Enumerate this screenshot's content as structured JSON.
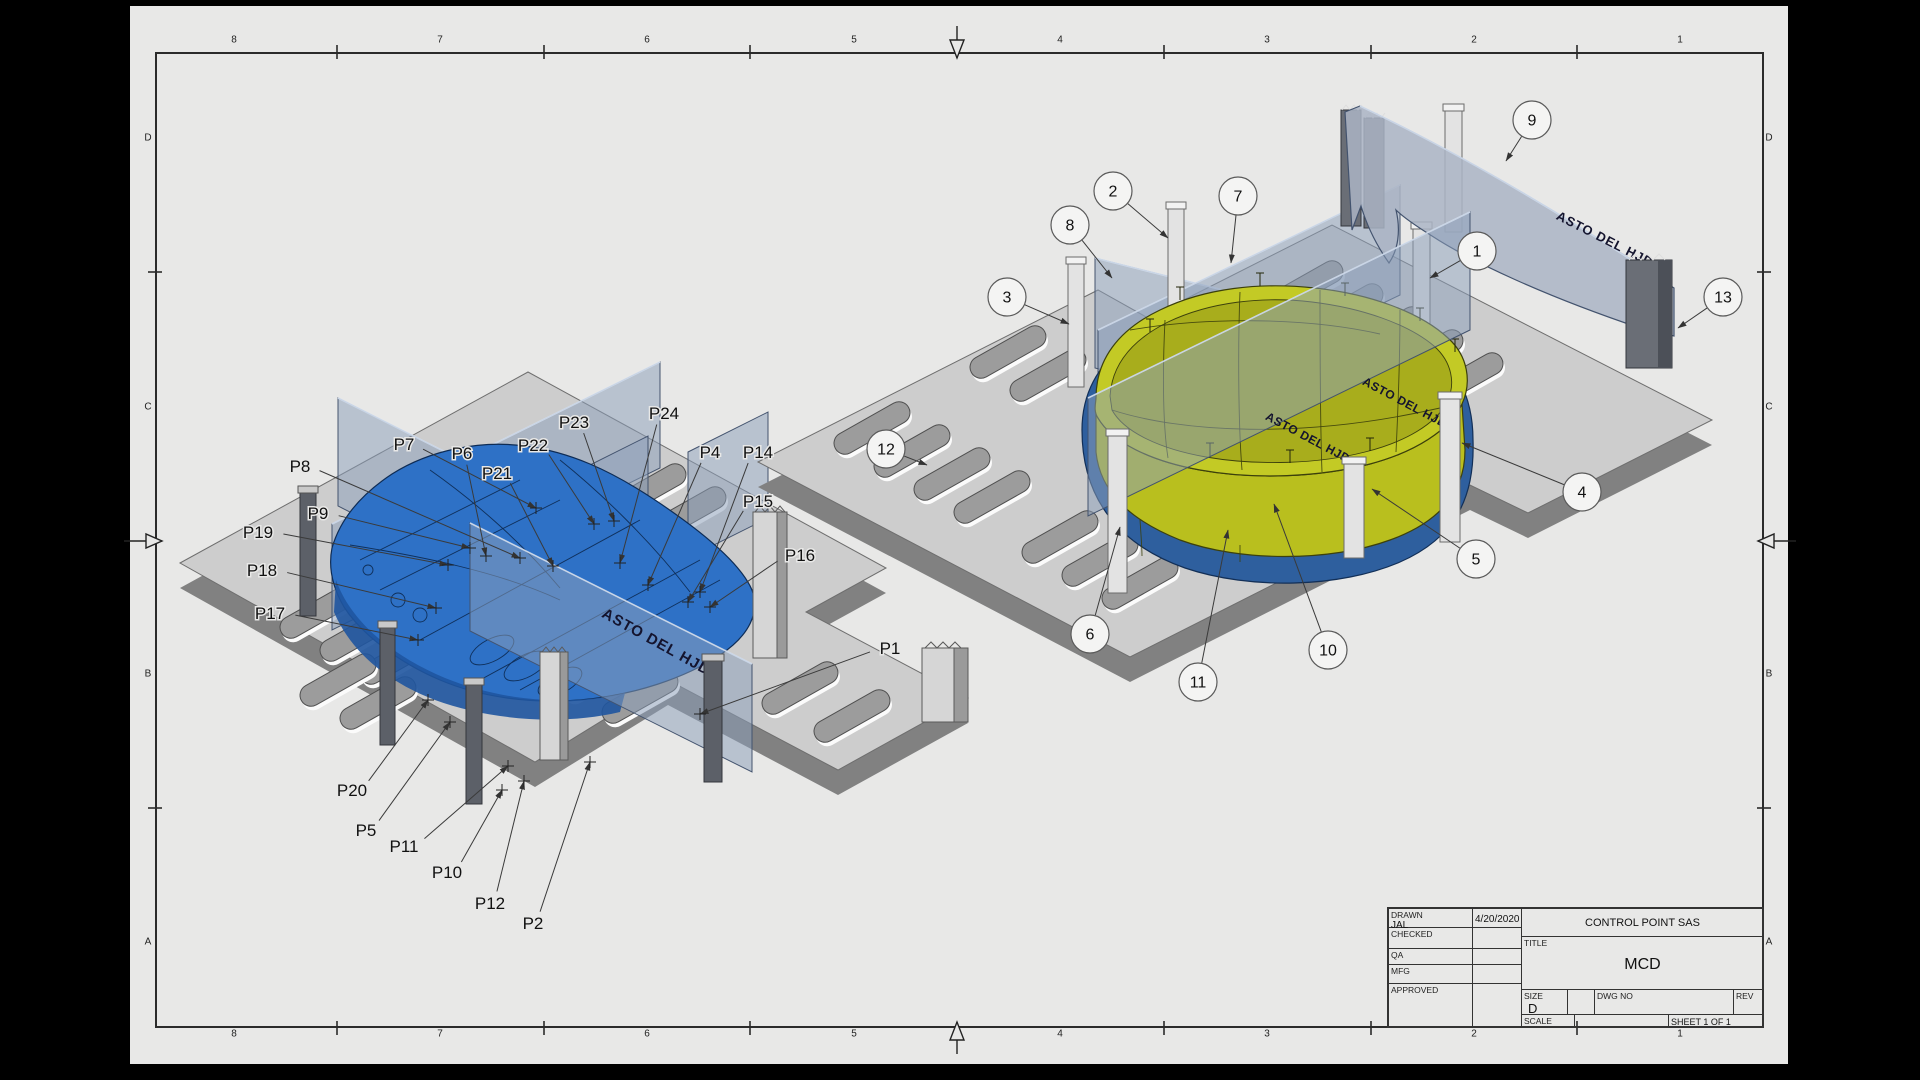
{
  "doc_type": "engineering-drawing",
  "part_text": "ASTO DEL HJD",
  "title_block": {
    "rows": [
      {
        "label": "DRAWN",
        "value": "JAL",
        "date": "4/20/2020"
      },
      {
        "label": "CHECKED",
        "value": "",
        "date": ""
      },
      {
        "label": "QA",
        "value": "",
        "date": ""
      },
      {
        "label": "MFG",
        "value": "",
        "date": ""
      },
      {
        "label": "APPROVED",
        "value": "",
        "date": ""
      }
    ],
    "company": "CONTROL POINT SAS",
    "title_label": "TITLE",
    "title": "MCD",
    "size_label": "SIZE",
    "size_value": "D",
    "dwg_label": "DWG NO",
    "rev_label": "REV",
    "scale_label": "SCALE",
    "sheet_text": "SHEET 1  OF 1"
  },
  "zones": {
    "cols": [
      "8",
      "7",
      "6",
      "5",
      "4",
      "3",
      "2",
      "1"
    ],
    "rows": [
      "D",
      "C",
      "B",
      "A"
    ]
  },
  "left_view": {
    "labels": [
      {
        "id": "P8",
        "x": 300,
        "y": 466,
        "tx": 520,
        "ty": 558
      },
      {
        "id": "P7",
        "x": 404,
        "y": 444,
        "tx": 536,
        "ty": 508
      },
      {
        "id": "P6",
        "x": 462,
        "y": 453,
        "tx": 486,
        "ty": 556
      },
      {
        "id": "P21",
        "x": 497,
        "y": 473,
        "tx": 553,
        "ty": 566
      },
      {
        "id": "P22",
        "x": 533,
        "y": 445,
        "tx": 594,
        "ty": 524
      },
      {
        "id": "P23",
        "x": 574,
        "y": 422,
        "tx": 614,
        "ty": 521
      },
      {
        "id": "P24",
        "x": 664,
        "y": 413,
        "tx": 620,
        "ty": 563
      },
      {
        "id": "P4",
        "x": 710,
        "y": 452,
        "tx": 648,
        "ty": 585
      },
      {
        "id": "P14",
        "x": 758,
        "y": 452,
        "tx": 700,
        "ty": 592
      },
      {
        "id": "P15",
        "x": 758,
        "y": 501,
        "tx": 688,
        "ty": 602
      },
      {
        "id": "P16",
        "x": 800,
        "y": 555,
        "tx": 710,
        "ty": 607
      },
      {
        "id": "P1",
        "x": 890,
        "y": 648,
        "tx": 700,
        "ty": 714
      },
      {
        "id": "P9",
        "x": 318,
        "y": 513,
        "tx": 470,
        "ty": 548
      },
      {
        "id": "P19",
        "x": 258,
        "y": 532,
        "tx": 448,
        "ty": 565
      },
      {
        "id": "P18",
        "x": 262,
        "y": 570,
        "tx": 436,
        "ty": 608
      },
      {
        "id": "P17",
        "x": 270,
        "y": 613,
        "tx": 418,
        "ty": 640
      },
      {
        "id": "P20",
        "x": 352,
        "y": 790,
        "tx": 428,
        "ty": 700
      },
      {
        "id": "P5",
        "x": 366,
        "y": 830,
        "tx": 450,
        "ty": 722
      },
      {
        "id": "P11",
        "x": 404,
        "y": 846,
        "tx": 508,
        "ty": 766
      },
      {
        "id": "P10",
        "x": 447,
        "y": 872,
        "tx": 502,
        "ty": 790
      },
      {
        "id": "P12",
        "x": 490,
        "y": 903,
        "tx": 524,
        "ty": 781
      },
      {
        "id": "P2",
        "x": 533,
        "y": 923,
        "tx": 590,
        "ty": 762
      }
    ]
  },
  "right_view": {
    "balloons": [
      {
        "id": "1",
        "x": 1477,
        "y": 251,
        "tx": 1430,
        "ty": 278
      },
      {
        "id": "2",
        "x": 1113,
        "y": 191,
        "tx": 1168,
        "ty": 238
      },
      {
        "id": "3",
        "x": 1007,
        "y": 297,
        "tx": 1069,
        "ty": 324
      },
      {
        "id": "4",
        "x": 1582,
        "y": 492,
        "tx": 1462,
        "ty": 443
      },
      {
        "id": "5",
        "x": 1476,
        "y": 559,
        "tx": 1372,
        "ty": 489
      },
      {
        "id": "6",
        "x": 1090,
        "y": 634,
        "tx": 1120,
        "ty": 527
      },
      {
        "id": "7",
        "x": 1238,
        "y": 196,
        "tx": 1231,
        "ty": 263
      },
      {
        "id": "8",
        "x": 1070,
        "y": 225,
        "tx": 1112,
        "ty": 278
      },
      {
        "id": "9",
        "x": 1532,
        "y": 120,
        "tx": 1506,
        "ty": 161
      },
      {
        "id": "10",
        "x": 1328,
        "y": 650,
        "tx": 1274,
        "ty": 504
      },
      {
        "id": "11",
        "x": 1198,
        "y": 682,
        "tx": 1228,
        "ty": 530
      },
      {
        "id": "12",
        "x": 886,
        "y": 449,
        "tx": 927,
        "ty": 465
      },
      {
        "id": "13",
        "x": 1723,
        "y": 297,
        "tx": 1678,
        "ty": 328
      }
    ]
  },
  "colors": {
    "sheet": "#e8e8e7",
    "frame": "#2b2b2b",
    "base_top": "#cdcdcd",
    "base_side": "#878787",
    "plate": "#8ca0ba",
    "plate_edge": "#43536e",
    "part_blue": "#2e71c6",
    "part_blue_dark": "#1f55a0",
    "part_yellow": "#b9bf1e",
    "part_yellow_dark": "#9aa018",
    "blue_band": "#2e5f9e",
    "post_light": "#e3e3e3",
    "post_dark": "#5c6068"
  }
}
